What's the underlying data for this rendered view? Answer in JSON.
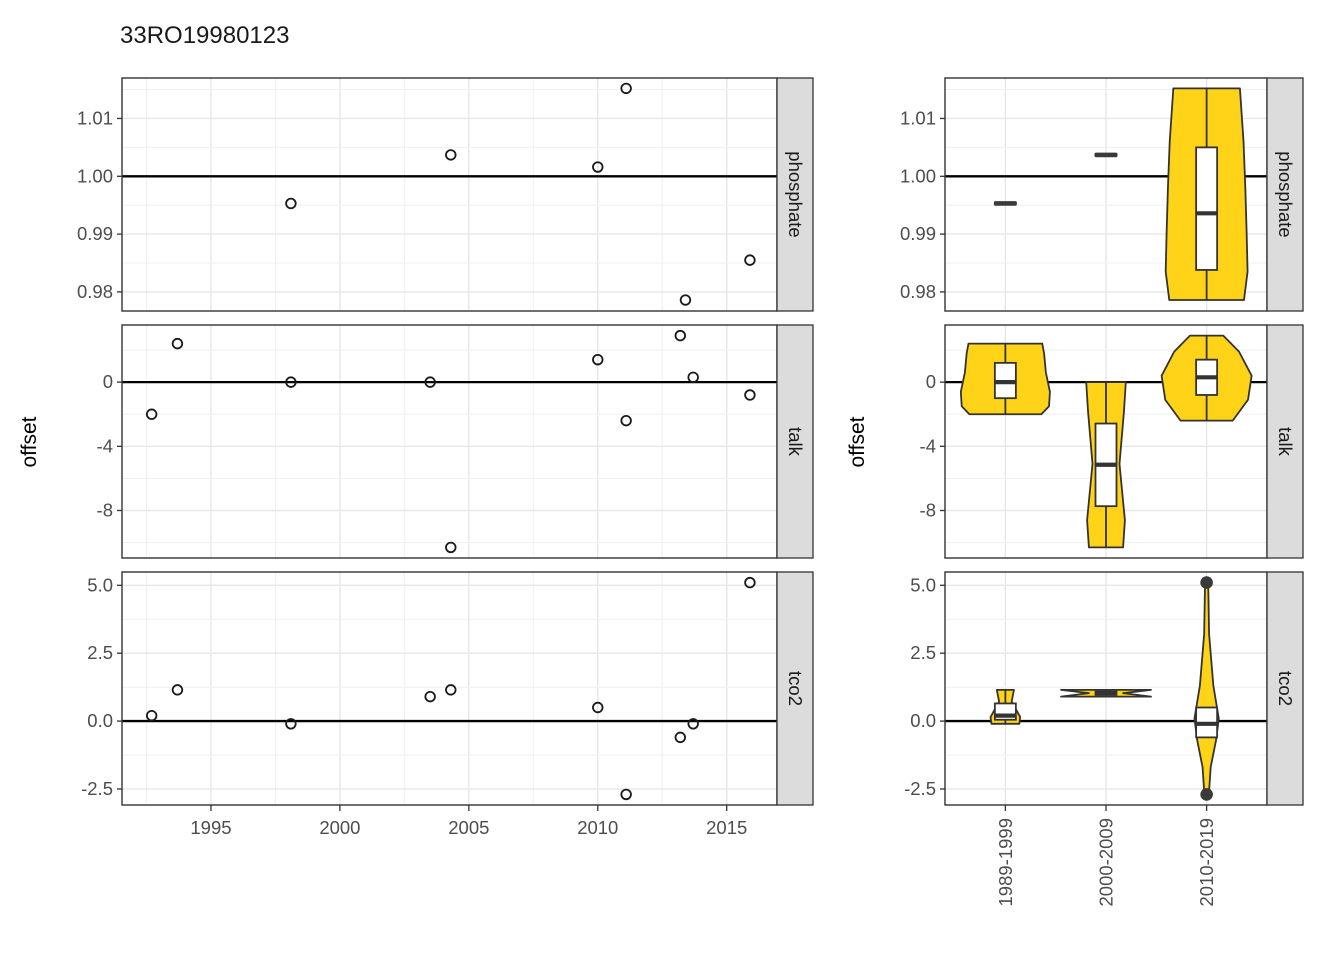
{
  "title": "33RO19980123",
  "colors": {
    "violin_fill": "#FFD317",
    "outline": "#333333",
    "strip_bg": "#DCDCDC",
    "panel_border": "#343434",
    "grid_major": "#E7E7E7",
    "grid_minor": "#F1F1F1",
    "axis_text": "#4D4D4D",
    "ref_line": "#000000",
    "point_stroke": "#1a1a1a"
  },
  "chart_data": [
    {
      "type": "scatter",
      "title": "33RO19980123",
      "xlabel": "",
      "ylabel": "offset",
      "xlim": [
        1991.55,
        2016.95
      ],
      "x_ticks": [
        {
          "v": 1995,
          "label": "1995"
        },
        {
          "v": 2000,
          "label": "2000"
        },
        {
          "v": 2005,
          "label": "2005"
        },
        {
          "v": 2010,
          "label": "2010"
        },
        {
          "v": 2015,
          "label": "2015"
        }
      ],
      "facets": [
        {
          "label": "phosphate",
          "ref_y": 1.0,
          "ylim": [
            0.9767,
            1.017
          ],
          "y_ticks": [
            {
              "v": 1.01,
              "label": "1.01"
            },
            {
              "v": 1.0,
              "label": "1.00"
            },
            {
              "v": 0.99,
              "label": "0.99"
            },
            {
              "v": 0.98,
              "label": "0.98"
            }
          ],
          "points": [
            [
              1998.1,
              0.9953
            ],
            [
              2004.3,
              1.0037
            ],
            [
              2010.0,
              1.0016
            ],
            [
              2011.1,
              1.0152
            ],
            [
              2013.4,
              0.9786
            ],
            [
              2015.9,
              0.9855
            ]
          ]
        },
        {
          "label": "talk",
          "ref_y": 0,
          "ylim": [
            -10.96,
            3.56
          ],
          "y_ticks": [
            {
              "v": 0,
              "label": "0"
            },
            {
              "v": -4,
              "label": "-4"
            },
            {
              "v": -8,
              "label": "-8"
            }
          ],
          "points": [
            [
              1992.7,
              -2.0
            ],
            [
              1993.7,
              2.4
            ],
            [
              1998.1,
              0.0
            ],
            [
              2003.5,
              0.0
            ],
            [
              2004.3,
              -10.3
            ],
            [
              2010.0,
              1.4
            ],
            [
              2011.1,
              -2.4
            ],
            [
              2013.2,
              2.9
            ],
            [
              2013.7,
              0.3
            ],
            [
              2015.9,
              -0.8
            ]
          ]
        },
        {
          "label": "tco2",
          "ref_y": 0,
          "ylim": [
            -3.09,
            5.49
          ],
          "y_ticks": [
            {
              "v": 5.0,
              "label": "5.0"
            },
            {
              "v": 2.5,
              "label": "2.5"
            },
            {
              "v": 0.0,
              "label": "0.0"
            },
            {
              "v": -2.5,
              "label": "-2.5"
            }
          ],
          "points": [
            [
              1992.7,
              0.2
            ],
            [
              1993.7,
              1.15
            ],
            [
              1998.1,
              -0.1
            ],
            [
              2003.5,
              0.9
            ],
            [
              2004.3,
              1.15
            ],
            [
              2010.0,
              0.5
            ],
            [
              2011.1,
              -2.7
            ],
            [
              2013.2,
              -0.6
            ],
            [
              2013.7,
              -0.1
            ],
            [
              2015.9,
              5.1
            ]
          ]
        }
      ]
    },
    {
      "type": "violin",
      "title": "",
      "xlabel": "",
      "ylabel": "offset",
      "categories": [
        "1989-1999",
        "2000-2009",
        "2010-2019"
      ],
      "facets": [
        {
          "label": "phosphate",
          "ref_y": 1.0,
          "ylim": [
            0.9767,
            1.017
          ],
          "y_ticks": [
            {
              "v": 1.01,
              "label": "1.01"
            },
            {
              "v": 1.0,
              "label": "1.00"
            },
            {
              "v": 0.99,
              "label": "0.99"
            },
            {
              "v": 0.98,
              "label": "0.98"
            }
          ],
          "groups": [
            {
              "kind": "dash",
              "value": 0.9953
            },
            {
              "kind": "dash",
              "value": 1.0037
            },
            {
              "kind": "violin",
              "stats": {
                "min": 0.9786,
                "q1": 0.9838,
                "median": 0.9936,
                "q3": 1.005,
                "max": 1.0152,
                "whisker_min": 0.9786,
                "whisker_max": 1.0152
              },
              "outliers": [],
              "shape": [
                [
                  1.0152,
                  0.74
                ],
                [
                  1.006,
                  0.82
                ],
                [
                  0.998,
                  0.86
                ],
                [
                  0.99,
                  0.89
                ],
                [
                  0.9835,
                  0.91
                ],
                [
                  0.9786,
                  0.83
                ]
              ]
            }
          ]
        },
        {
          "label": "talk",
          "ref_y": 0,
          "ylim": [
            -10.96,
            3.56
          ],
          "y_ticks": [
            {
              "v": 0,
              "label": "0"
            },
            {
              "v": -4,
              "label": "-4"
            },
            {
              "v": -8,
              "label": "-8"
            }
          ],
          "groups": [
            {
              "kind": "violin",
              "stats": {
                "min": -2.0,
                "q1": -1.0,
                "median": 0.0,
                "q3": 1.2,
                "max": 2.4,
                "whisker_min": -2.0,
                "whisker_max": 2.4
              },
              "outliers": [],
              "shape": [
                [
                  2.4,
                  0.82
                ],
                [
                  1.8,
                  0.86
                ],
                [
                  0.6,
                  0.9
                ],
                [
                  -0.6,
                  0.99
                ],
                [
                  -1.5,
                  0.97
                ],
                [
                  -2.0,
                  0.8
                ]
              ]
            },
            {
              "kind": "violin",
              "stats": {
                "min": -10.3,
                "q1": -7.73,
                "median": -5.15,
                "q3": -2.58,
                "max": 0.0,
                "whisker_min": -10.3,
                "whisker_max": 0.0
              },
              "outliers": [],
              "shape": [
                [
                  0.0,
                  0.44
                ],
                [
                  -1.8,
                  0.4
                ],
                [
                  -5.1,
                  0.3
                ],
                [
                  -8.6,
                  0.42
                ],
                [
                  -10.3,
                  0.38
                ]
              ]
            },
            {
              "kind": "violin",
              "stats": {
                "min": -2.4,
                "q1": -0.8,
                "median": 0.3,
                "q3": 1.4,
                "max": 2.9,
                "whisker_min": -2.4,
                "whisker_max": 2.9
              },
              "outliers": [],
              "shape": [
                [
                  2.9,
                  0.37
                ],
                [
                  1.9,
                  0.72
                ],
                [
                  0.4,
                  1.0
                ],
                [
                  -1.1,
                  0.92
                ],
                [
                  -2.4,
                  0.58
                ]
              ]
            }
          ]
        },
        {
          "label": "tco2",
          "ref_y": 0,
          "ylim": [
            -3.09,
            5.49
          ],
          "y_ticks": [
            {
              "v": 5.0,
              "label": "5.0"
            },
            {
              "v": 2.5,
              "label": "2.5"
            },
            {
              "v": 0.0,
              "label": "0.0"
            },
            {
              "v": -2.5,
              "label": "-2.5"
            }
          ],
          "groups": [
            {
              "kind": "violin",
              "stats": {
                "min": -0.1,
                "q1": 0.05,
                "median": 0.2,
                "q3": 0.65,
                "max": 1.15,
                "whisker_min": -0.1,
                "whisker_max": 1.15
              },
              "outliers": [],
              "shape": [
                [
                  1.15,
                  0.19
                ],
                [
                  0.72,
                  0.14
                ],
                [
                  0.15,
                  0.33
                ],
                [
                  -0.1,
                  0.31
                ]
              ]
            },
            {
              "kind": "violin",
              "stats": {
                "min": 0.9,
                "q1": 0.963,
                "median": 1.025,
                "q3": 1.088,
                "max": 1.15,
                "whisker_min": 0.9,
                "whisker_max": 1.15
              },
              "outliers": [],
              "shape": [
                [
                  1.15,
                  1.0
                ],
                [
                  1.03,
                  0.38
                ],
                [
                  0.9,
                  1.0
                ]
              ]
            },
            {
              "kind": "violin",
              "stats": {
                "min": -2.7,
                "q1": -0.6,
                "median": -0.1,
                "q3": 0.5,
                "max": 5.1,
                "whisker_min": -0.6,
                "whisker_max": 0.5
              },
              "outliers": [
                5.1,
                -2.7
              ],
              "shape": [
                [
                  5.1,
                  0.035
                ],
                [
                  3.2,
                  0.055
                ],
                [
                  1.3,
                  0.15
                ],
                [
                  0.1,
                  0.27
                ],
                [
                  -0.7,
                  0.21
                ],
                [
                  -1.7,
                  0.09
                ],
                [
                  -2.7,
                  0.05
                ]
              ]
            }
          ]
        }
      ]
    }
  ]
}
